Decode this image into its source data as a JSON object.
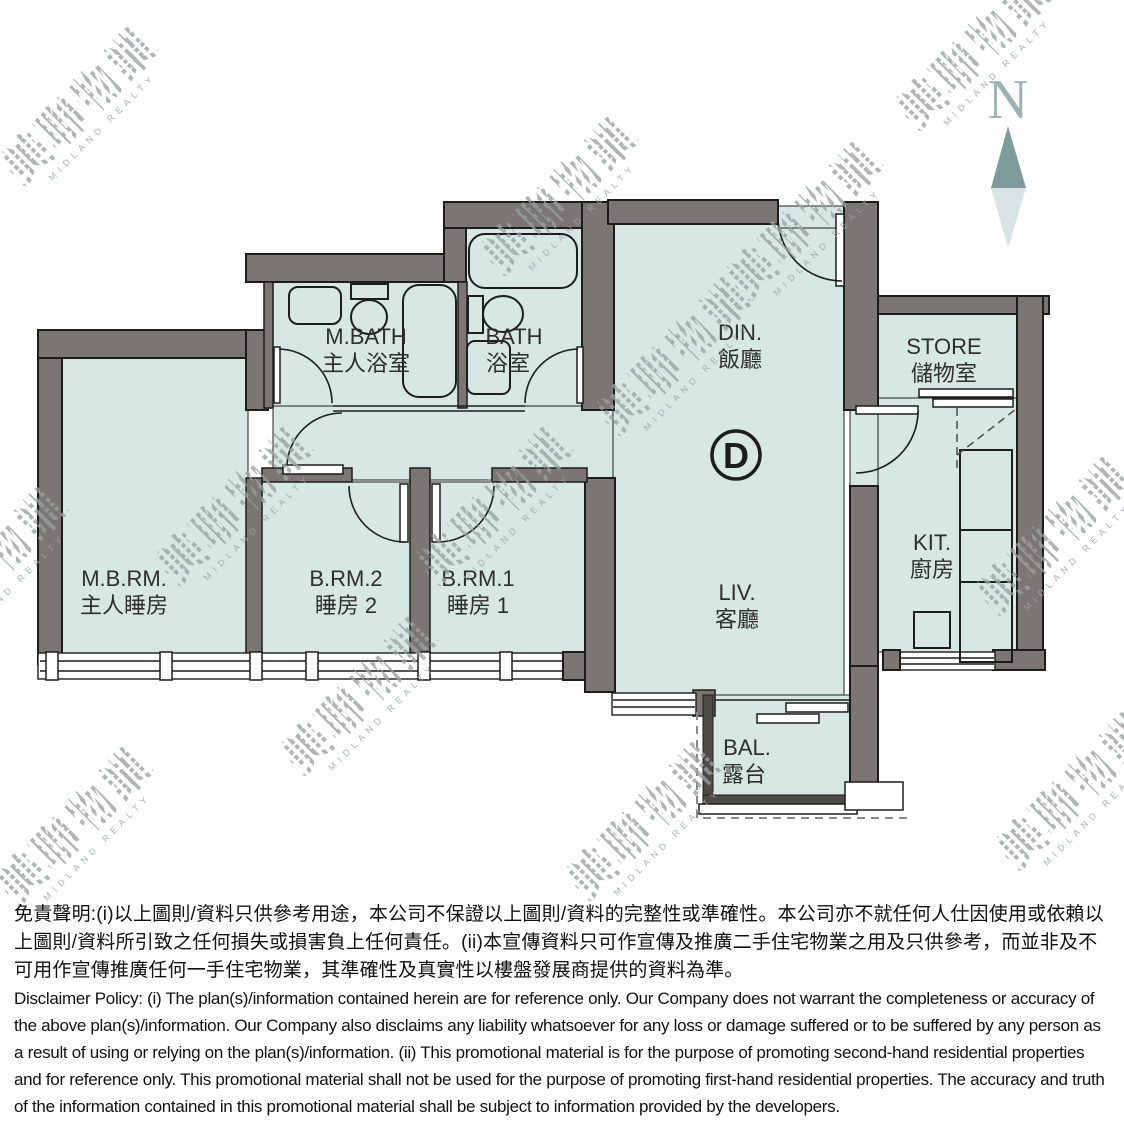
{
  "plan": {
    "unit_label": "D",
    "north_label": "N",
    "rooms": {
      "mbath": {
        "abbr": "M.BATH",
        "cn": "主人浴室"
      },
      "bath": {
        "abbr": "BATH",
        "cn": "浴室"
      },
      "din": {
        "abbr": "DIN.",
        "cn": "飯廳"
      },
      "store": {
        "abbr": "STORE",
        "cn": "儲物室"
      },
      "mbrm": {
        "abbr": "M.B.RM.",
        "cn": "主人睡房"
      },
      "brm2": {
        "abbr": "B.RM.2",
        "cn": "睡房 2"
      },
      "brm1": {
        "abbr": "B.RM.1",
        "cn": "睡房 1"
      },
      "liv": {
        "abbr": "LIV.",
        "cn": "客廳"
      },
      "kit": {
        "abbr": "KIT.",
        "cn": "廚房"
      },
      "bal": {
        "abbr": "BAL.",
        "cn": "露台"
      }
    }
  },
  "watermark": {
    "cn": "美聯物業",
    "en": "MIDLAND REALTY"
  },
  "disclaimer": {
    "zh": "免責聲明:(i)以上圖則/資料只供參考用途，本公司不保證以上圖則/資料的完整性或準確性。本公司亦不就任何人仕因使用或依賴以上圖則/資料所引致之任何損失或損害負上任何責任。(ii)本宣傳資料只可作宣傳及推廣二手住宅物業之用及只供參考，而並非及不可用作宣傳推廣任何一手住宅物業，其準確性及真實性以樓盤發展商提供的資料為準。",
    "en": "Disclaimer Policy: (i) The plan(s)/information contained herein are for reference only. Our Company does not warrant the completeness or accuracy of the above plan(s)/information. Our Company also disclaims any liability whatsoever for any loss or damage suffered or to be suffered by any person as a result of using or relying on the plan(s)/information. (ii) This promotional material is for the purpose of promoting second-hand residential properties and for reference only. This promotional material shall not be used for the purpose of promoting first-hand residential properties. The accuracy and truth of the information contained in this promotional material shall be subject to information provided by the developers."
  },
  "colors": {
    "floor": "#d7e7e4",
    "wall": "#7b7673",
    "line": "#1d1d1d",
    "north_dark": "#7e9b9b",
    "north_light": "#d8e4e3",
    "watermark": "#9ea8a8"
  }
}
